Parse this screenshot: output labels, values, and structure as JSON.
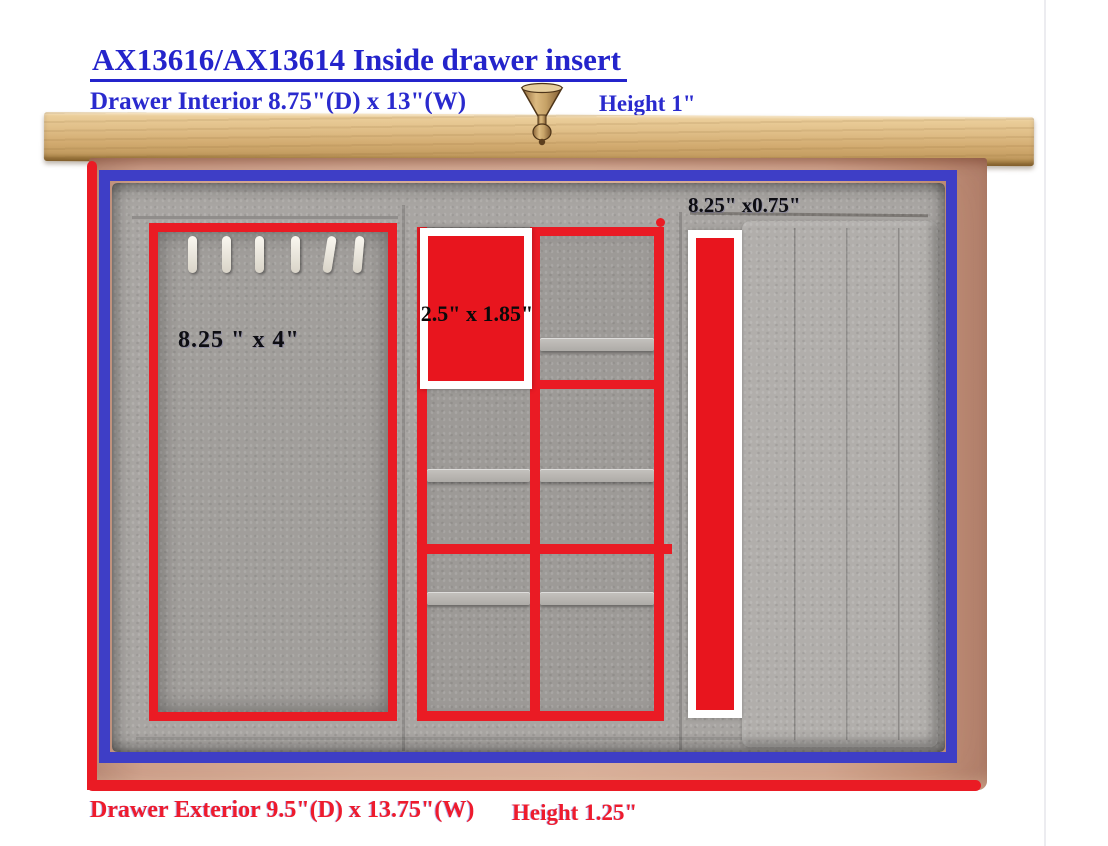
{
  "page": {
    "title": "AX13616/AX13614 Inside drawer insert"
  },
  "interior": {
    "dimensions": "Drawer Interior 8.75\"(D) x 13\"(W)",
    "height": "Height 1\""
  },
  "exterior": {
    "dimensions": "Drawer Exterior 9.5\"(D) x 13.75\"(W)",
    "height": "Height 1.25\""
  },
  "compartments": {
    "left_hook_panel": "8.25 \" x 4\"",
    "middle_cell": "2.5\" x 1.85\"",
    "right_slot": "8.25\" x0.75\""
  },
  "colors": {
    "annotation_red": "#ea1b24",
    "annotation_blue": "#3e3ec6",
    "heading_blue": "#2424cb",
    "dimension_text_black": "#0d0d12",
    "exterior_text_red": "#ee1b2d",
    "wood_top": "#d4ab72",
    "drawer_wood": "#d4a791",
    "velvet_gray": "#a8a5a2",
    "highlight_white": "#ffffff"
  }
}
